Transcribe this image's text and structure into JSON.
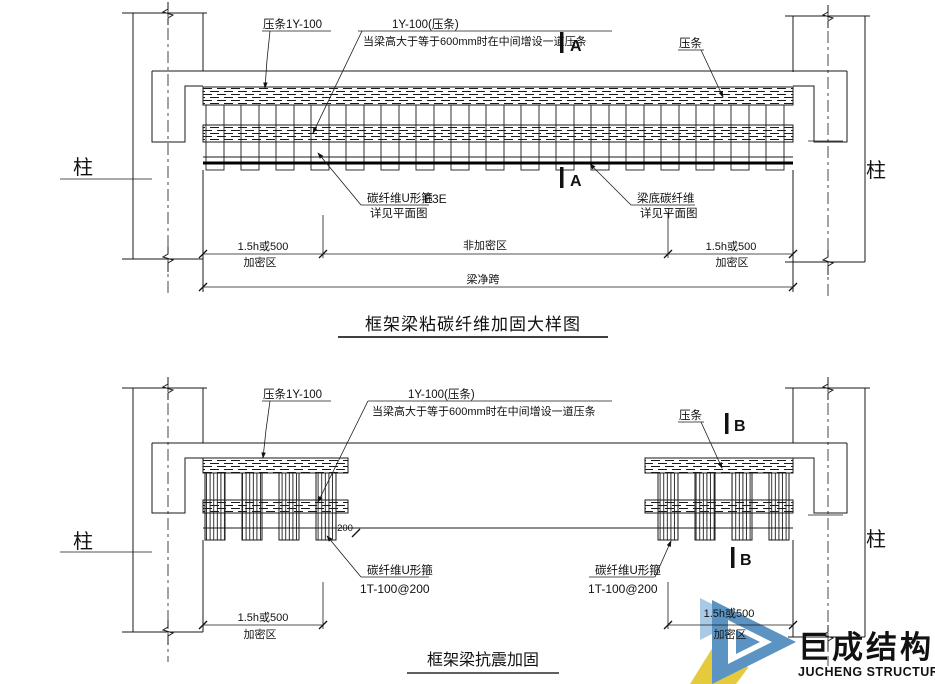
{
  "a": {
    "title": "框架梁粘碳纤维加固大样图",
    "mark": "A",
    "col": "柱",
    "strip_left": "压条1Y-100",
    "note1": "1Y-100(压条)",
    "note2": "当梁高大于等于600mm时在中间增设一道压条",
    "strip_right": "压条",
    "uwrap1": "碳纤维U形箍",
    "uwrap2": "详见平面图",
    "uwrap_mark": "E3E",
    "soffit1": "梁底碳纤维",
    "soffit2": "详见平面图",
    "dim_zone": "1.5h或500",
    "dim_zone_name": "加密区",
    "dim_mid": "非加密区",
    "dim_span": "梁净跨"
  },
  "b": {
    "title": "框架梁抗震加固",
    "mark": "B",
    "col": "柱",
    "strip_left": "压条1Y-100",
    "note1": "1Y-100(压条)",
    "note2": "当梁高大于等于600mm时在中间增设一道压条",
    "strip_right": "压条",
    "uwrap1": "碳纤维U形箍",
    "uwrap2": "1T-100@200",
    "spacing": "200",
    "dim_zone": "1.5h或500",
    "dim_zone_name": "加密区"
  },
  "logo": {
    "cn": "巨成结构",
    "en": "JUCHENG STRUCTURE",
    "colors": {
      "blue": "#5b93c3",
      "light_blue": "#a9c9e4",
      "yellow": "#e6ca3e",
      "text_blue": "#79abd9",
      "text_gray": "#9b9b9b"
    }
  }
}
